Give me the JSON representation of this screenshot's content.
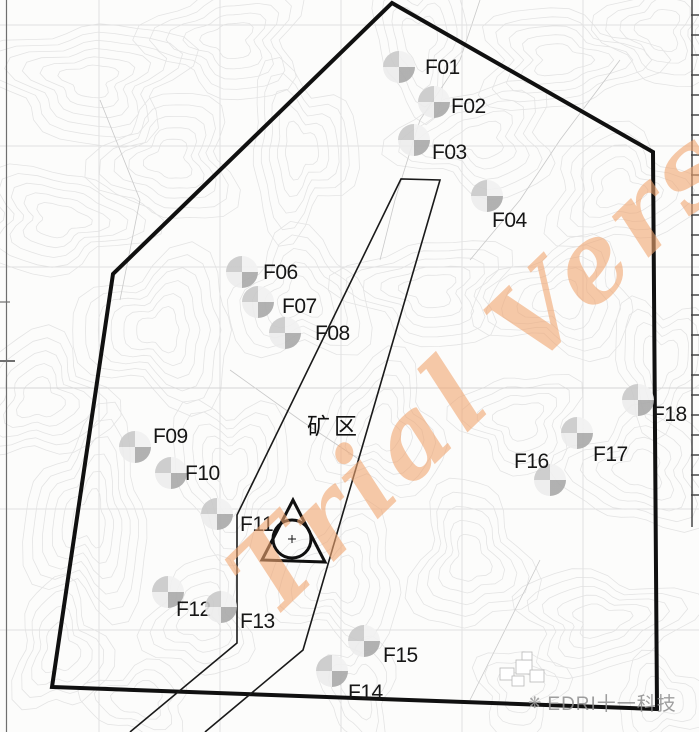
{
  "map": {
    "region_label": "矿区",
    "watermark_text": "Trial Versi",
    "logo": {
      "icon": "swoosh-mark-icon",
      "text": "EDRI十一科技"
    },
    "colors": {
      "watermark": "#f1a671",
      "boundary": "#101010",
      "parcel_line": "#1a1a1a",
      "symbol_dark": "#a9a9a9",
      "symbol_light": "#c9c9c9",
      "contour": "#e4e4e4"
    },
    "turbines": [
      {
        "id": "F01",
        "label": "F01",
        "symbol": {
          "x": 399,
          "y": 67
        },
        "label_pos": {
          "x": 425,
          "y": 57
        }
      },
      {
        "id": "F02",
        "label": "F02",
        "symbol": {
          "x": 434,
          "y": 102
        },
        "label_pos": {
          "x": 451,
          "y": 96
        }
      },
      {
        "id": "F03",
        "label": "F03",
        "symbol": {
          "x": 414,
          "y": 140
        },
        "label_pos": {
          "x": 432,
          "y": 142
        }
      },
      {
        "id": "F04",
        "label": "F04",
        "symbol": {
          "x": 487,
          "y": 196
        },
        "label_pos": {
          "x": 492,
          "y": 210
        }
      },
      {
        "id": "F06",
        "label": "F06",
        "symbol": {
          "x": 242,
          "y": 272
        },
        "label_pos": {
          "x": 263,
          "y": 262
        }
      },
      {
        "id": "F07",
        "label": "F07",
        "symbol": {
          "x": 258,
          "y": 302
        },
        "label_pos": {
          "x": 282,
          "y": 296
        }
      },
      {
        "id": "F08",
        "label": "F08",
        "symbol": {
          "x": 285,
          "y": 333
        },
        "label_pos": {
          "x": 315,
          "y": 323
        }
      },
      {
        "id": "F09",
        "label": "F09",
        "symbol": {
          "x": 135,
          "y": 447
        },
        "label_pos": {
          "x": 153,
          "y": 426
        }
      },
      {
        "id": "F10",
        "label": "F10",
        "symbol": {
          "x": 171,
          "y": 473
        },
        "label_pos": {
          "x": 185,
          "y": 463
        }
      },
      {
        "id": "F11",
        "label": "F11",
        "symbol": {
          "x": 217,
          "y": 514
        },
        "label_pos": {
          "x": 240,
          "y": 514
        }
      },
      {
        "id": "F12",
        "label": "F12",
        "symbol": {
          "x": 168,
          "y": 592
        },
        "label_pos": {
          "x": 176,
          "y": 599
        }
      },
      {
        "id": "F13",
        "label": "F13",
        "symbol": {
          "x": 221,
          "y": 607
        },
        "label_pos": {
          "x": 240,
          "y": 611
        }
      },
      {
        "id": "F14",
        "label": "F14",
        "symbol": {
          "x": 332,
          "y": 671
        },
        "label_pos": {
          "x": 348,
          "y": 682
        }
      },
      {
        "id": "F15",
        "label": "F15",
        "symbol": {
          "x": 364,
          "y": 641
        },
        "label_pos": {
          "x": 383,
          "y": 645
        }
      },
      {
        "id": "F16",
        "label": "F16",
        "symbol": {
          "x": 550,
          "y": 480
        },
        "label_pos": {
          "x": 514,
          "y": 451
        }
      },
      {
        "id": "F17",
        "label": "F17",
        "symbol": {
          "x": 577,
          "y": 433
        },
        "label_pos": {
          "x": 593,
          "y": 444
        }
      },
      {
        "id": "F18",
        "label": "F18",
        "symbol": {
          "x": 638,
          "y": 400
        },
        "label_pos": {
          "x": 652,
          "y": 404
        }
      }
    ],
    "shapes": {
      "boundary": {
        "type": "polygon",
        "points": [
          [
            392,
            3
          ],
          [
            653,
            152
          ],
          [
            657,
            709
          ],
          [
            52,
            687
          ],
          [
            113,
            274
          ]
        ]
      },
      "mine_parcel": {
        "type": "polyline",
        "points": [
          [
            130,
            732
          ],
          [
            237,
            643
          ],
          [
            237,
            515
          ],
          [
            401,
            179
          ],
          [
            440,
            180
          ],
          [
            303,
            650
          ],
          [
            205,
            732
          ]
        ]
      },
      "monument": {
        "triangle": [
          [
            293,
            500
          ],
          [
            262,
            560
          ],
          [
            325,
            562
          ]
        ],
        "circle": {
          "cx": 292,
          "cy": 539,
          "r": 19
        }
      }
    }
  }
}
